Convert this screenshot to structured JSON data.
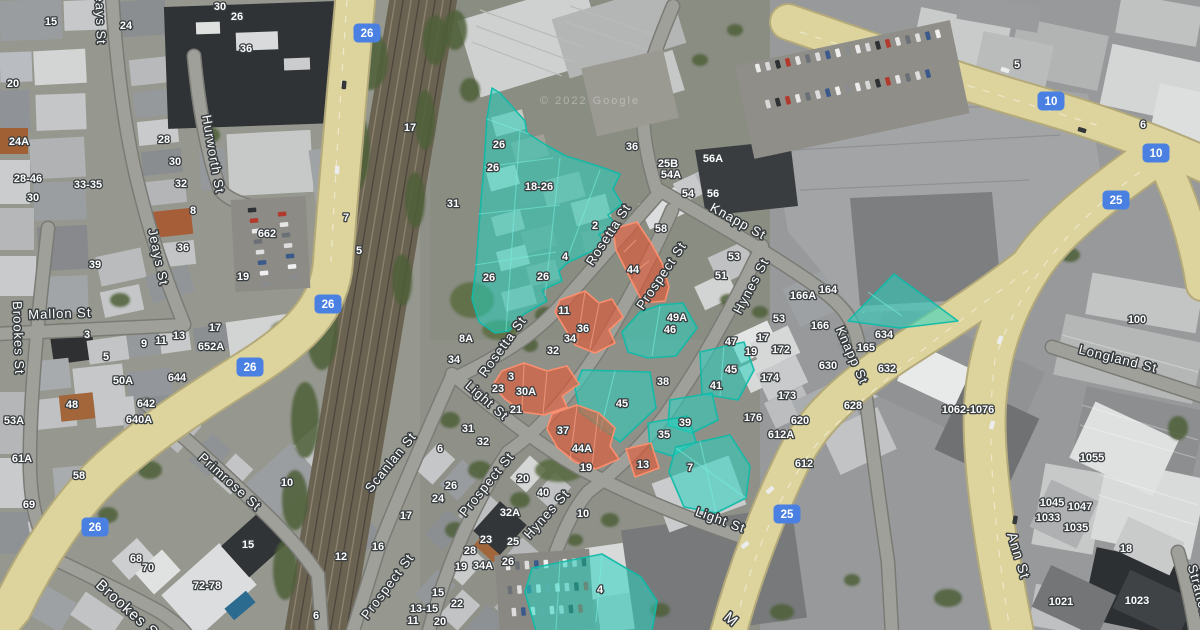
{
  "map": {
    "attribution": "© 2022 Google",
    "colors": {
      "parcel_teal_fill": "rgba(34,213,194,0.52)",
      "parcel_teal_stroke": "rgba(16,186,168,0.95)",
      "parcel_teal_inner": "rgba(120,240,226,0.55)",
      "parcel_orange_fill": "rgba(233,84,48,0.58)",
      "parcel_orange_stroke": "rgba(255,143,110,0.95)",
      "parcel_orange_inner": "rgba(255,170,140,0.6)",
      "shield_blue": "#4a80e2",
      "road_major": "#ddd49d",
      "road_minor": "#a0a09b",
      "label_halo": "#383d40"
    },
    "route_shields": [
      {
        "t": "26",
        "x": 367,
        "y": 33
      },
      {
        "t": "26",
        "x": 328,
        "y": 304
      },
      {
        "t": "26",
        "x": 250,
        "y": 367
      },
      {
        "t": "26",
        "x": 95,
        "y": 527
      },
      {
        "t": "10",
        "x": 1051,
        "y": 101
      },
      {
        "t": "10",
        "x": 1156,
        "y": 153
      },
      {
        "t": "25",
        "x": 1116,
        "y": 200
      },
      {
        "t": "25",
        "x": 787,
        "y": 514
      }
    ],
    "street_labels": [
      {
        "text": "Jeays St",
        "x": 96,
        "y": 16,
        "rot": 88
      },
      {
        "text": "Jeays St",
        "x": 154,
        "y": 258,
        "rot": 78
      },
      {
        "text": "Hurworth St",
        "x": 209,
        "y": 155,
        "rot": 80
      },
      {
        "text": "Brookes St",
        "x": 14,
        "y": 338,
        "rot": 88
      },
      {
        "text": "Brookes St",
        "x": 126,
        "y": 614,
        "rot": 42,
        "size": 15
      },
      {
        "text": "Mallon St",
        "x": 60,
        "y": 318,
        "rot": -2
      },
      {
        "text": "Primrose St",
        "x": 227,
        "y": 485,
        "rot": 42
      },
      {
        "text": "Scanlan St",
        "x": 394,
        "y": 465,
        "rot": -51
      },
      {
        "text": "Prospect St",
        "x": 391,
        "y": 589,
        "rot": -53
      },
      {
        "text": "Prospect St",
        "x": 490,
        "y": 487,
        "rot": -51
      },
      {
        "text": "Prospect St",
        "x": 665,
        "y": 278,
        "rot": -56
      },
      {
        "text": "Rosetta St",
        "x": 612,
        "y": 237,
        "rot": -57
      },
      {
        "text": "Rosetta St",
        "x": 506,
        "y": 349,
        "rot": -54
      },
      {
        "text": "Light St",
        "x": 484,
        "y": 404,
        "rot": 41
      },
      {
        "text": "Light St",
        "x": 719,
        "y": 524,
        "rot": 20
      },
      {
        "text": "Hynes St",
        "x": 755,
        "y": 288,
        "rot": -62
      },
      {
        "text": "Hynes St",
        "x": 550,
        "y": 517,
        "rot": -48
      },
      {
        "text": "Knapp St",
        "x": 736,
        "y": 225,
        "rot": 29
      },
      {
        "text": "Knapp St",
        "x": 848,
        "y": 357,
        "rot": 66
      },
      {
        "text": "Longland St",
        "x": 1117,
        "y": 363,
        "rot": 14
      },
      {
        "text": "Ann St",
        "x": 1014,
        "y": 557,
        "rot": 73,
        "size": 14
      },
      {
        "text": "Stratton St",
        "x": 1197,
        "y": 601,
        "rot": 75
      },
      {
        "text": "M",
        "x": 728,
        "y": 623,
        "rot": 40,
        "size": 15
      }
    ],
    "number_labels": [
      {
        "x": 51,
        "y": 21,
        "t": "15"
      },
      {
        "x": 126,
        "y": 25,
        "t": "24"
      },
      {
        "x": 220,
        "y": 6,
        "t": "30"
      },
      {
        "x": 237,
        "y": 16,
        "t": "26"
      },
      {
        "x": 246,
        "y": 48,
        "t": "36"
      },
      {
        "x": 13,
        "y": 83,
        "t": "20"
      },
      {
        "x": 19,
        "y": 141,
        "t": "24A"
      },
      {
        "x": 164,
        "y": 139,
        "t": "28"
      },
      {
        "x": 175,
        "y": 161,
        "t": "30"
      },
      {
        "x": 181,
        "y": 183,
        "t": "32"
      },
      {
        "x": 28,
        "y": 178,
        "t": "28-46"
      },
      {
        "x": 88,
        "y": 184,
        "t": "33-35"
      },
      {
        "x": 33,
        "y": 197,
        "t": "30"
      },
      {
        "x": 193,
        "y": 210,
        "t": "8"
      },
      {
        "x": 267,
        "y": 233,
        "t": "662"
      },
      {
        "x": 183,
        "y": 247,
        "t": "36"
      },
      {
        "x": 95,
        "y": 264,
        "t": "39"
      },
      {
        "x": 243,
        "y": 276,
        "t": "19"
      },
      {
        "x": 346,
        "y": 217,
        "t": "7"
      },
      {
        "x": 359,
        "y": 250,
        "t": "5"
      },
      {
        "x": 410,
        "y": 127,
        "t": "17"
      },
      {
        "x": 453,
        "y": 203,
        "t": "31"
      },
      {
        "x": 87,
        "y": 334,
        "t": "3"
      },
      {
        "x": 106,
        "y": 356,
        "t": "5"
      },
      {
        "x": 144,
        "y": 343,
        "t": "9"
      },
      {
        "x": 161,
        "y": 340,
        "t": "11"
      },
      {
        "x": 179,
        "y": 335,
        "t": "13"
      },
      {
        "x": 215,
        "y": 327,
        "t": "17"
      },
      {
        "x": 211,
        "y": 346,
        "t": "652A"
      },
      {
        "x": 123,
        "y": 380,
        "t": "50A"
      },
      {
        "x": 177,
        "y": 377,
        "t": "644"
      },
      {
        "x": 72,
        "y": 404,
        "t": "48"
      },
      {
        "x": 146,
        "y": 403,
        "t": "642"
      },
      {
        "x": 139,
        "y": 419,
        "t": "640A"
      },
      {
        "x": 14,
        "y": 420,
        "t": "53A"
      },
      {
        "x": 22,
        "y": 458,
        "t": "61A"
      },
      {
        "x": 79,
        "y": 475,
        "t": "58"
      },
      {
        "x": 29,
        "y": 504,
        "t": "69"
      },
      {
        "x": 136,
        "y": 558,
        "t": "68"
      },
      {
        "x": 148,
        "y": 567,
        "t": "70"
      },
      {
        "x": 207,
        "y": 585,
        "t": "72-78"
      },
      {
        "x": 248,
        "y": 544,
        "t": "15"
      },
      {
        "x": 287,
        "y": 482,
        "t": "10"
      },
      {
        "x": 341,
        "y": 556,
        "t": "12"
      },
      {
        "x": 378,
        "y": 546,
        "t": "16"
      },
      {
        "x": 316,
        "y": 615,
        "t": "6"
      },
      {
        "x": 499,
        "y": 144,
        "t": "26"
      },
      {
        "x": 493,
        "y": 167,
        "t": "26"
      },
      {
        "x": 539,
        "y": 186,
        "t": "18-26"
      },
      {
        "x": 595,
        "y": 225,
        "t": "2"
      },
      {
        "x": 565,
        "y": 256,
        "t": "4"
      },
      {
        "x": 489,
        "y": 277,
        "t": "26"
      },
      {
        "x": 543,
        "y": 276,
        "t": "26"
      },
      {
        "x": 632,
        "y": 146,
        "t": "36"
      },
      {
        "x": 668,
        "y": 163,
        "t": "25B"
      },
      {
        "x": 671,
        "y": 174,
        "t": "54A"
      },
      {
        "x": 713,
        "y": 158,
        "t": "56A"
      },
      {
        "x": 688,
        "y": 193,
        "t": "54"
      },
      {
        "x": 713,
        "y": 193,
        "t": "56"
      },
      {
        "x": 661,
        "y": 228,
        "t": "58"
      },
      {
        "x": 734,
        "y": 256,
        "t": "53"
      },
      {
        "x": 721,
        "y": 275,
        "t": "51"
      },
      {
        "x": 633,
        "y": 269,
        "t": "44"
      },
      {
        "x": 564,
        "y": 310,
        "t": "11"
      },
      {
        "x": 583,
        "y": 328,
        "t": "36"
      },
      {
        "x": 570,
        "y": 338,
        "t": "34"
      },
      {
        "x": 553,
        "y": 350,
        "t": "32"
      },
      {
        "x": 511,
        "y": 376,
        "t": "3"
      },
      {
        "x": 498,
        "y": 388,
        "t": "23"
      },
      {
        "x": 526,
        "y": 391,
        "t": "30A"
      },
      {
        "x": 516,
        "y": 409,
        "t": "21"
      },
      {
        "x": 563,
        "y": 430,
        "t": "37"
      },
      {
        "x": 582,
        "y": 448,
        "t": "44A"
      },
      {
        "x": 586,
        "y": 467,
        "t": "19"
      },
      {
        "x": 643,
        "y": 464,
        "t": "13"
      },
      {
        "x": 466,
        "y": 338,
        "t": "8A"
      },
      {
        "x": 454,
        "y": 359,
        "t": "34"
      },
      {
        "x": 468,
        "y": 428,
        "t": "31"
      },
      {
        "x": 483,
        "y": 441,
        "t": "32"
      },
      {
        "x": 440,
        "y": 448,
        "t": "6"
      },
      {
        "x": 451,
        "y": 485,
        "t": "26"
      },
      {
        "x": 438,
        "y": 498,
        "t": "24"
      },
      {
        "x": 406,
        "y": 515,
        "t": "17"
      },
      {
        "x": 523,
        "y": 478,
        "t": "20"
      },
      {
        "x": 543,
        "y": 492,
        "t": "40"
      },
      {
        "x": 510,
        "y": 512,
        "t": "32A"
      },
      {
        "x": 583,
        "y": 513,
        "t": "10"
      },
      {
        "x": 486,
        "y": 539,
        "t": "23"
      },
      {
        "x": 513,
        "y": 541,
        "t": "25"
      },
      {
        "x": 470,
        "y": 550,
        "t": "28"
      },
      {
        "x": 508,
        "y": 561,
        "t": "26"
      },
      {
        "x": 461,
        "y": 566,
        "t": "19"
      },
      {
        "x": 483,
        "y": 565,
        "t": "34A"
      },
      {
        "x": 438,
        "y": 592,
        "t": "15"
      },
      {
        "x": 457,
        "y": 603,
        "t": "22"
      },
      {
        "x": 424,
        "y": 608,
        "t": "13-15"
      },
      {
        "x": 413,
        "y": 620,
        "t": "11"
      },
      {
        "x": 440,
        "y": 621,
        "t": "20"
      },
      {
        "x": 622,
        "y": 403,
        "t": "45"
      },
      {
        "x": 663,
        "y": 381,
        "t": "38"
      },
      {
        "x": 685,
        "y": 422,
        "t": "39"
      },
      {
        "x": 664,
        "y": 434,
        "t": "35"
      },
      {
        "x": 690,
        "y": 467,
        "t": "7"
      },
      {
        "x": 600,
        "y": 589,
        "t": "4"
      },
      {
        "x": 677,
        "y": 317,
        "t": "49A"
      },
      {
        "x": 670,
        "y": 329,
        "t": "46"
      },
      {
        "x": 731,
        "y": 369,
        "t": "45"
      },
      {
        "x": 716,
        "y": 385,
        "t": "41"
      },
      {
        "x": 1017,
        "y": 64,
        "t": "5"
      },
      {
        "x": 1143,
        "y": 124,
        "t": "6"
      },
      {
        "x": 828,
        "y": 289,
        "t": "164"
      },
      {
        "x": 803,
        "y": 295,
        "t": "166A"
      },
      {
        "x": 820,
        "y": 325,
        "t": "166"
      },
      {
        "x": 779,
        "y": 318,
        "t": "53"
      },
      {
        "x": 763,
        "y": 337,
        "t": "17"
      },
      {
        "x": 731,
        "y": 341,
        "t": "47"
      },
      {
        "x": 751,
        "y": 351,
        "t": "19"
      },
      {
        "x": 781,
        "y": 349,
        "t": "172"
      },
      {
        "x": 770,
        "y": 377,
        "t": "174"
      },
      {
        "x": 787,
        "y": 395,
        "t": "173"
      },
      {
        "x": 753,
        "y": 417,
        "t": "176"
      },
      {
        "x": 781,
        "y": 434,
        "t": "612A"
      },
      {
        "x": 800,
        "y": 420,
        "t": "620"
      },
      {
        "x": 804,
        "y": 463,
        "t": "612"
      },
      {
        "x": 853,
        "y": 405,
        "t": "628"
      },
      {
        "x": 828,
        "y": 365,
        "t": "630"
      },
      {
        "x": 887,
        "y": 368,
        "t": "632"
      },
      {
        "x": 866,
        "y": 347,
        "t": "165"
      },
      {
        "x": 884,
        "y": 334,
        "t": "634"
      },
      {
        "x": 1137,
        "y": 319,
        "t": "100"
      },
      {
        "x": 968,
        "y": 409,
        "t": "1062-1076"
      },
      {
        "x": 1092,
        "y": 457,
        "t": "1055"
      },
      {
        "x": 1052,
        "y": 502,
        "t": "1045"
      },
      {
        "x": 1080,
        "y": 506,
        "t": "1047"
      },
      {
        "x": 1048,
        "y": 517,
        "t": "1033"
      },
      {
        "x": 1076,
        "y": 527,
        "t": "1035"
      },
      {
        "x": 1126,
        "y": 548,
        "t": "18"
      },
      {
        "x": 1061,
        "y": 601,
        "t": "1021"
      },
      {
        "x": 1137,
        "y": 600,
        "t": "1023"
      }
    ],
    "parcels": [
      {
        "color": "teal",
        "points": "492,88 500,93 525,121 527,133 546,145 566,156 601,167 620,174 613,189 622,204 608,215 616,225 599,234 605,245 567,263 559,271 562,281 542,290 547,301 524,314 509,331 495,333 479,322 472,299 476,268 480,213 484,166 487,118",
        "inner": "M487,119 L529,134 M484,167 L553,158 M479,214 L560,205 M475,265 L556,252 M520,130 L506,331 M560,158 L545,296 M600,170 L566,262"
      },
      {
        "color": "teal",
        "points": "622,332 640,312 660,305 683,303 697,328 676,356 648,358 628,352",
        "inner": "M660,306 L652,356"
      },
      {
        "color": "teal",
        "points": "582,370 650,372 656,408 620,442 580,412 575,388",
        "inner": "M615,371 L600,432"
      },
      {
        "color": "teal",
        "points": "700,352 744,342 754,370 738,400 702,394",
        "inner": "M724,346 L720,396"
      },
      {
        "color": "teal",
        "points": "670,400 712,393 718,420 692,433 668,425"
      },
      {
        "color": "teal",
        "points": "648,423 688,416 696,442 672,456 650,449"
      },
      {
        "color": "teal",
        "points": "676,447 730,435 750,466 746,498 716,513 684,507 669,472",
        "inner": "M700,441 L716,512 M676,448 L746,498"
      },
      {
        "color": "teal",
        "points": "532,568 602,554 641,577 657,601 652,631 536,631 525,592",
        "inner": "M560,560 L556,630 M602,556 L596,622"
      },
      {
        "color": "teal",
        "points": "848,321 894,274 958,321 900,328",
        "inner": "M868,292 L902,316"
      },
      {
        "color": "orange",
        "points": "613,229 637,222 651,243 662,263 669,287 665,301 643,303 629,276 616,250",
        "inner": "M636,240 L624,252 M649,261 L635,272 M660,281 L644,293"
      },
      {
        "color": "orange",
        "points": "560,300 585,291 599,303 612,299 623,317 609,330 615,343 595,353 575,345 564,327 555,312",
        "inner": "M585,292 L577,344 M599,304 L590,349"
      },
      {
        "color": "orange",
        "points": "502,371 524,363 547,371 567,366 579,384 562,396 567,407 544,415 523,412 505,399 493,385",
        "inner": "M524,364 L522,411 M547,372 L543,414"
      },
      {
        "color": "orange",
        "points": "552,414 577,405 599,413 615,428 610,446 619,459 596,469 575,462 557,447 547,429",
        "inner": "M577,406 L570,461 M598,414 L592,466"
      },
      {
        "color": "orange",
        "points": "626,449 651,443 659,468 635,477"
      }
    ]
  }
}
